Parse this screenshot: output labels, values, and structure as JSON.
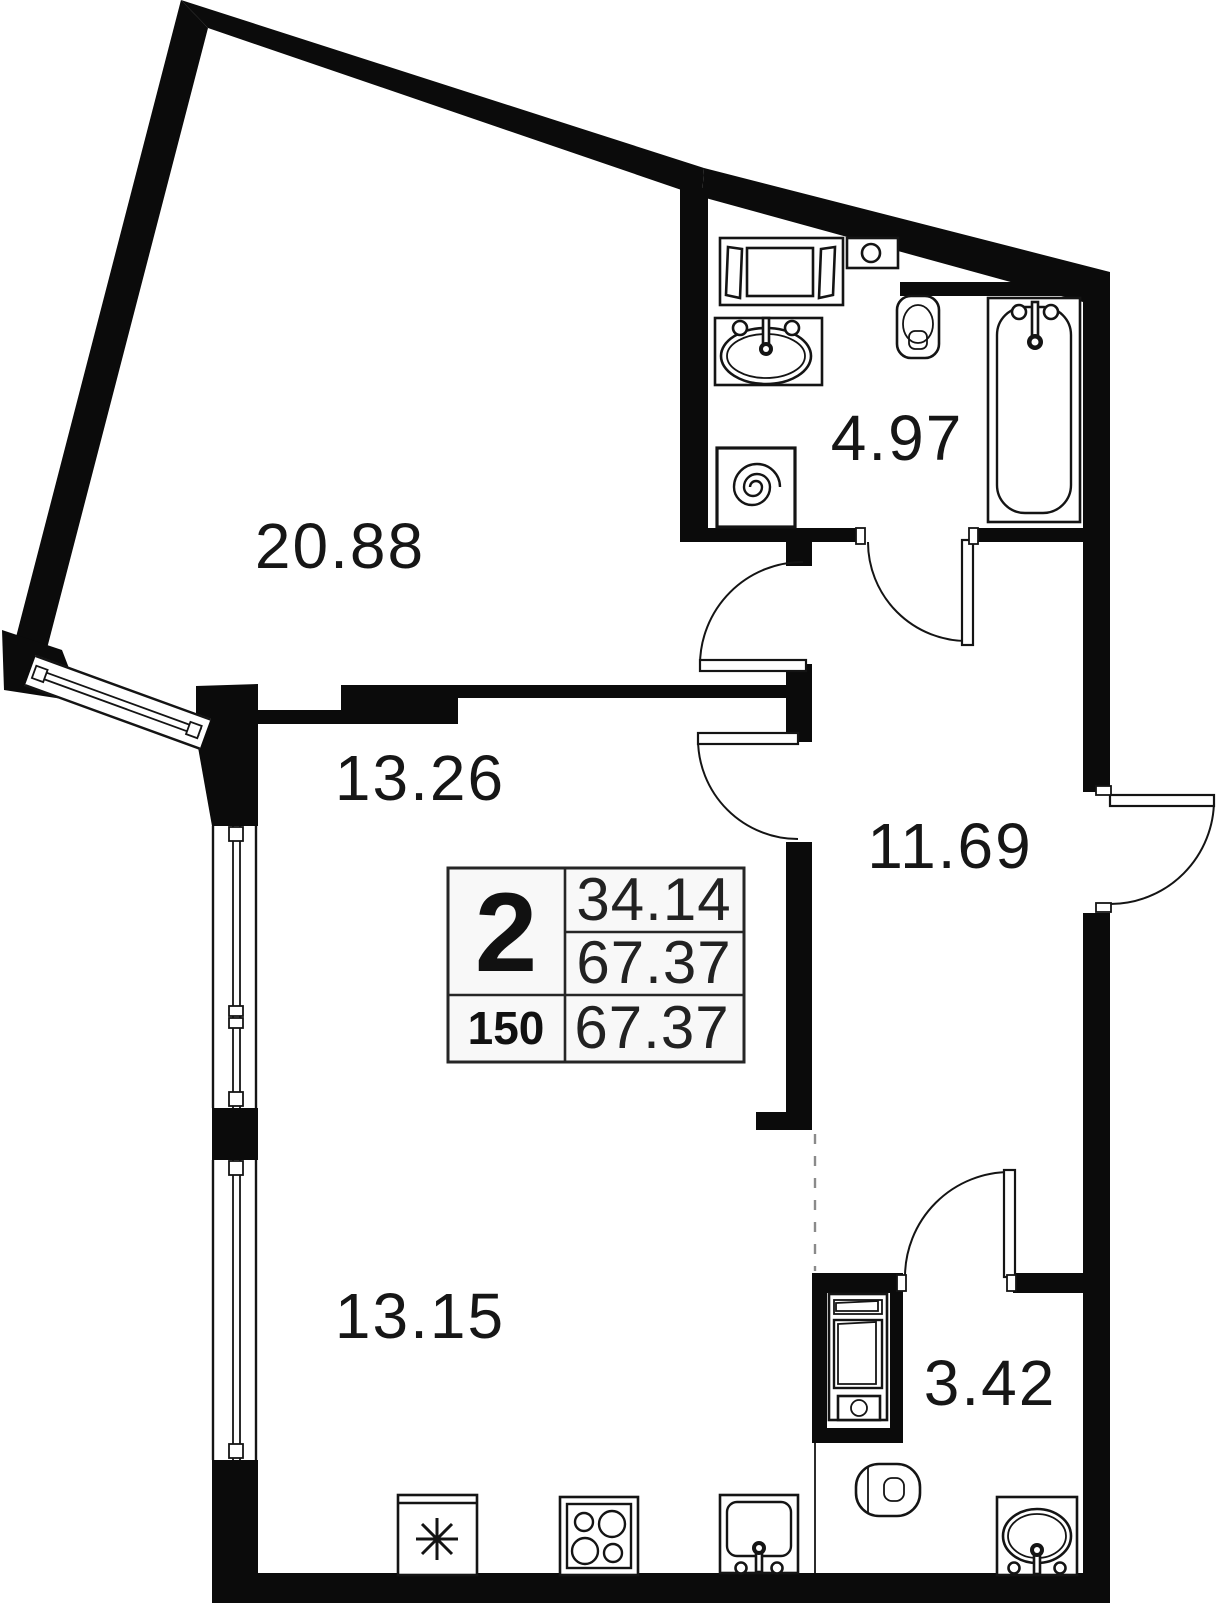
{
  "plan_type": "apartment-floor-plan",
  "colors": {
    "wall": "#0b0b0b",
    "line": "#141414",
    "table_background": "#f8f8f8",
    "dashed_boundary": "#8a8a8a",
    "paper": "#ffffff"
  },
  "rooms": [
    {
      "key": "living-room",
      "area": "20.88"
    },
    {
      "key": "bathroom",
      "area": "4.97"
    },
    {
      "key": "bedroom",
      "area": "13.26"
    },
    {
      "key": "hallway",
      "area": "11.69"
    },
    {
      "key": "kitchen-living",
      "area": "13.15"
    },
    {
      "key": "wc",
      "area": "3.42"
    }
  ],
  "info_table": {
    "rooms_count": "2",
    "area_living": "34.14",
    "area_total": "67.37",
    "unit_number": "150",
    "area_total_repeat": "67.37"
  },
  "fixtures": {
    "bathroom": [
      "cabinet-icon",
      "boiler-icon",
      "sink-icon",
      "washing-machine-icon",
      "toilet-icon",
      "bathtub-icon"
    ],
    "kitchen": [
      "fridge-icon",
      "stove-icon",
      "kitchen-sink-icon"
    ],
    "wc": [
      "washing-machine-icon",
      "toilet-icon",
      "sink-icon"
    ]
  }
}
